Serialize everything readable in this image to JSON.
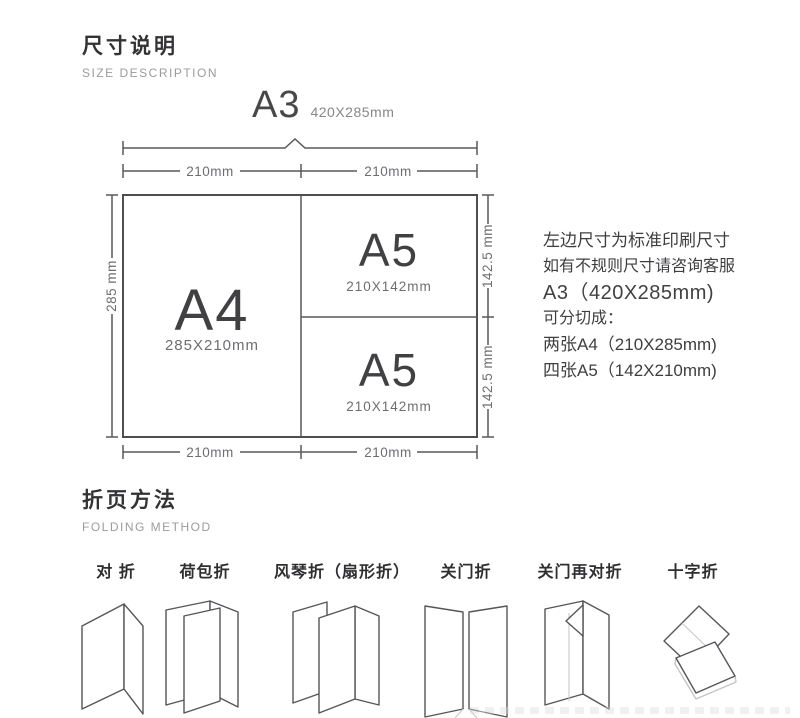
{
  "size_section": {
    "title": "尺寸说明",
    "subtitle": "SIZE DESCRIPTION",
    "a3_label": "A3",
    "a3_dims": "420X285mm",
    "dims": {
      "top_left_width": "210mm",
      "top_right_width": "210mm",
      "bottom_left_width": "210mm",
      "bottom_right_width": "210mm",
      "left_height": "285 mm",
      "right_top_height": "142.5 mm",
      "right_bottom_height": "142.5 mm"
    },
    "a4": {
      "label": "A4",
      "dims": "285X210mm"
    },
    "a5_top": {
      "label": "A5",
      "dims": "210X142mm"
    },
    "a5_bottom": {
      "label": "A5",
      "dims": "210X142mm"
    },
    "notes": {
      "line1": "左边尺寸为标准印刷尺寸",
      "line2": "如有不规则尺寸请咨询客服",
      "line3": "A3（420X285mm)",
      "line4": "可分切成：",
      "line5": "两张A4（210X285mm)",
      "line6": "四张A5（142X210mm)"
    }
  },
  "folding_section": {
    "title": "折页方法",
    "subtitle": "FOLDING METHOD",
    "methods": [
      {
        "label": "对 折"
      },
      {
        "label": "荷包折"
      },
      {
        "label": "风琴折（扇形折）"
      },
      {
        "label": "关门折"
      },
      {
        "label": "关门再对折"
      },
      {
        "label": "十字折"
      }
    ]
  },
  "colors": {
    "line": "#58595b",
    "text_dark": "#3a3a3c",
    "text_gray": "#6d6e71",
    "subtitle_gray": "#9b9b9d"
  }
}
